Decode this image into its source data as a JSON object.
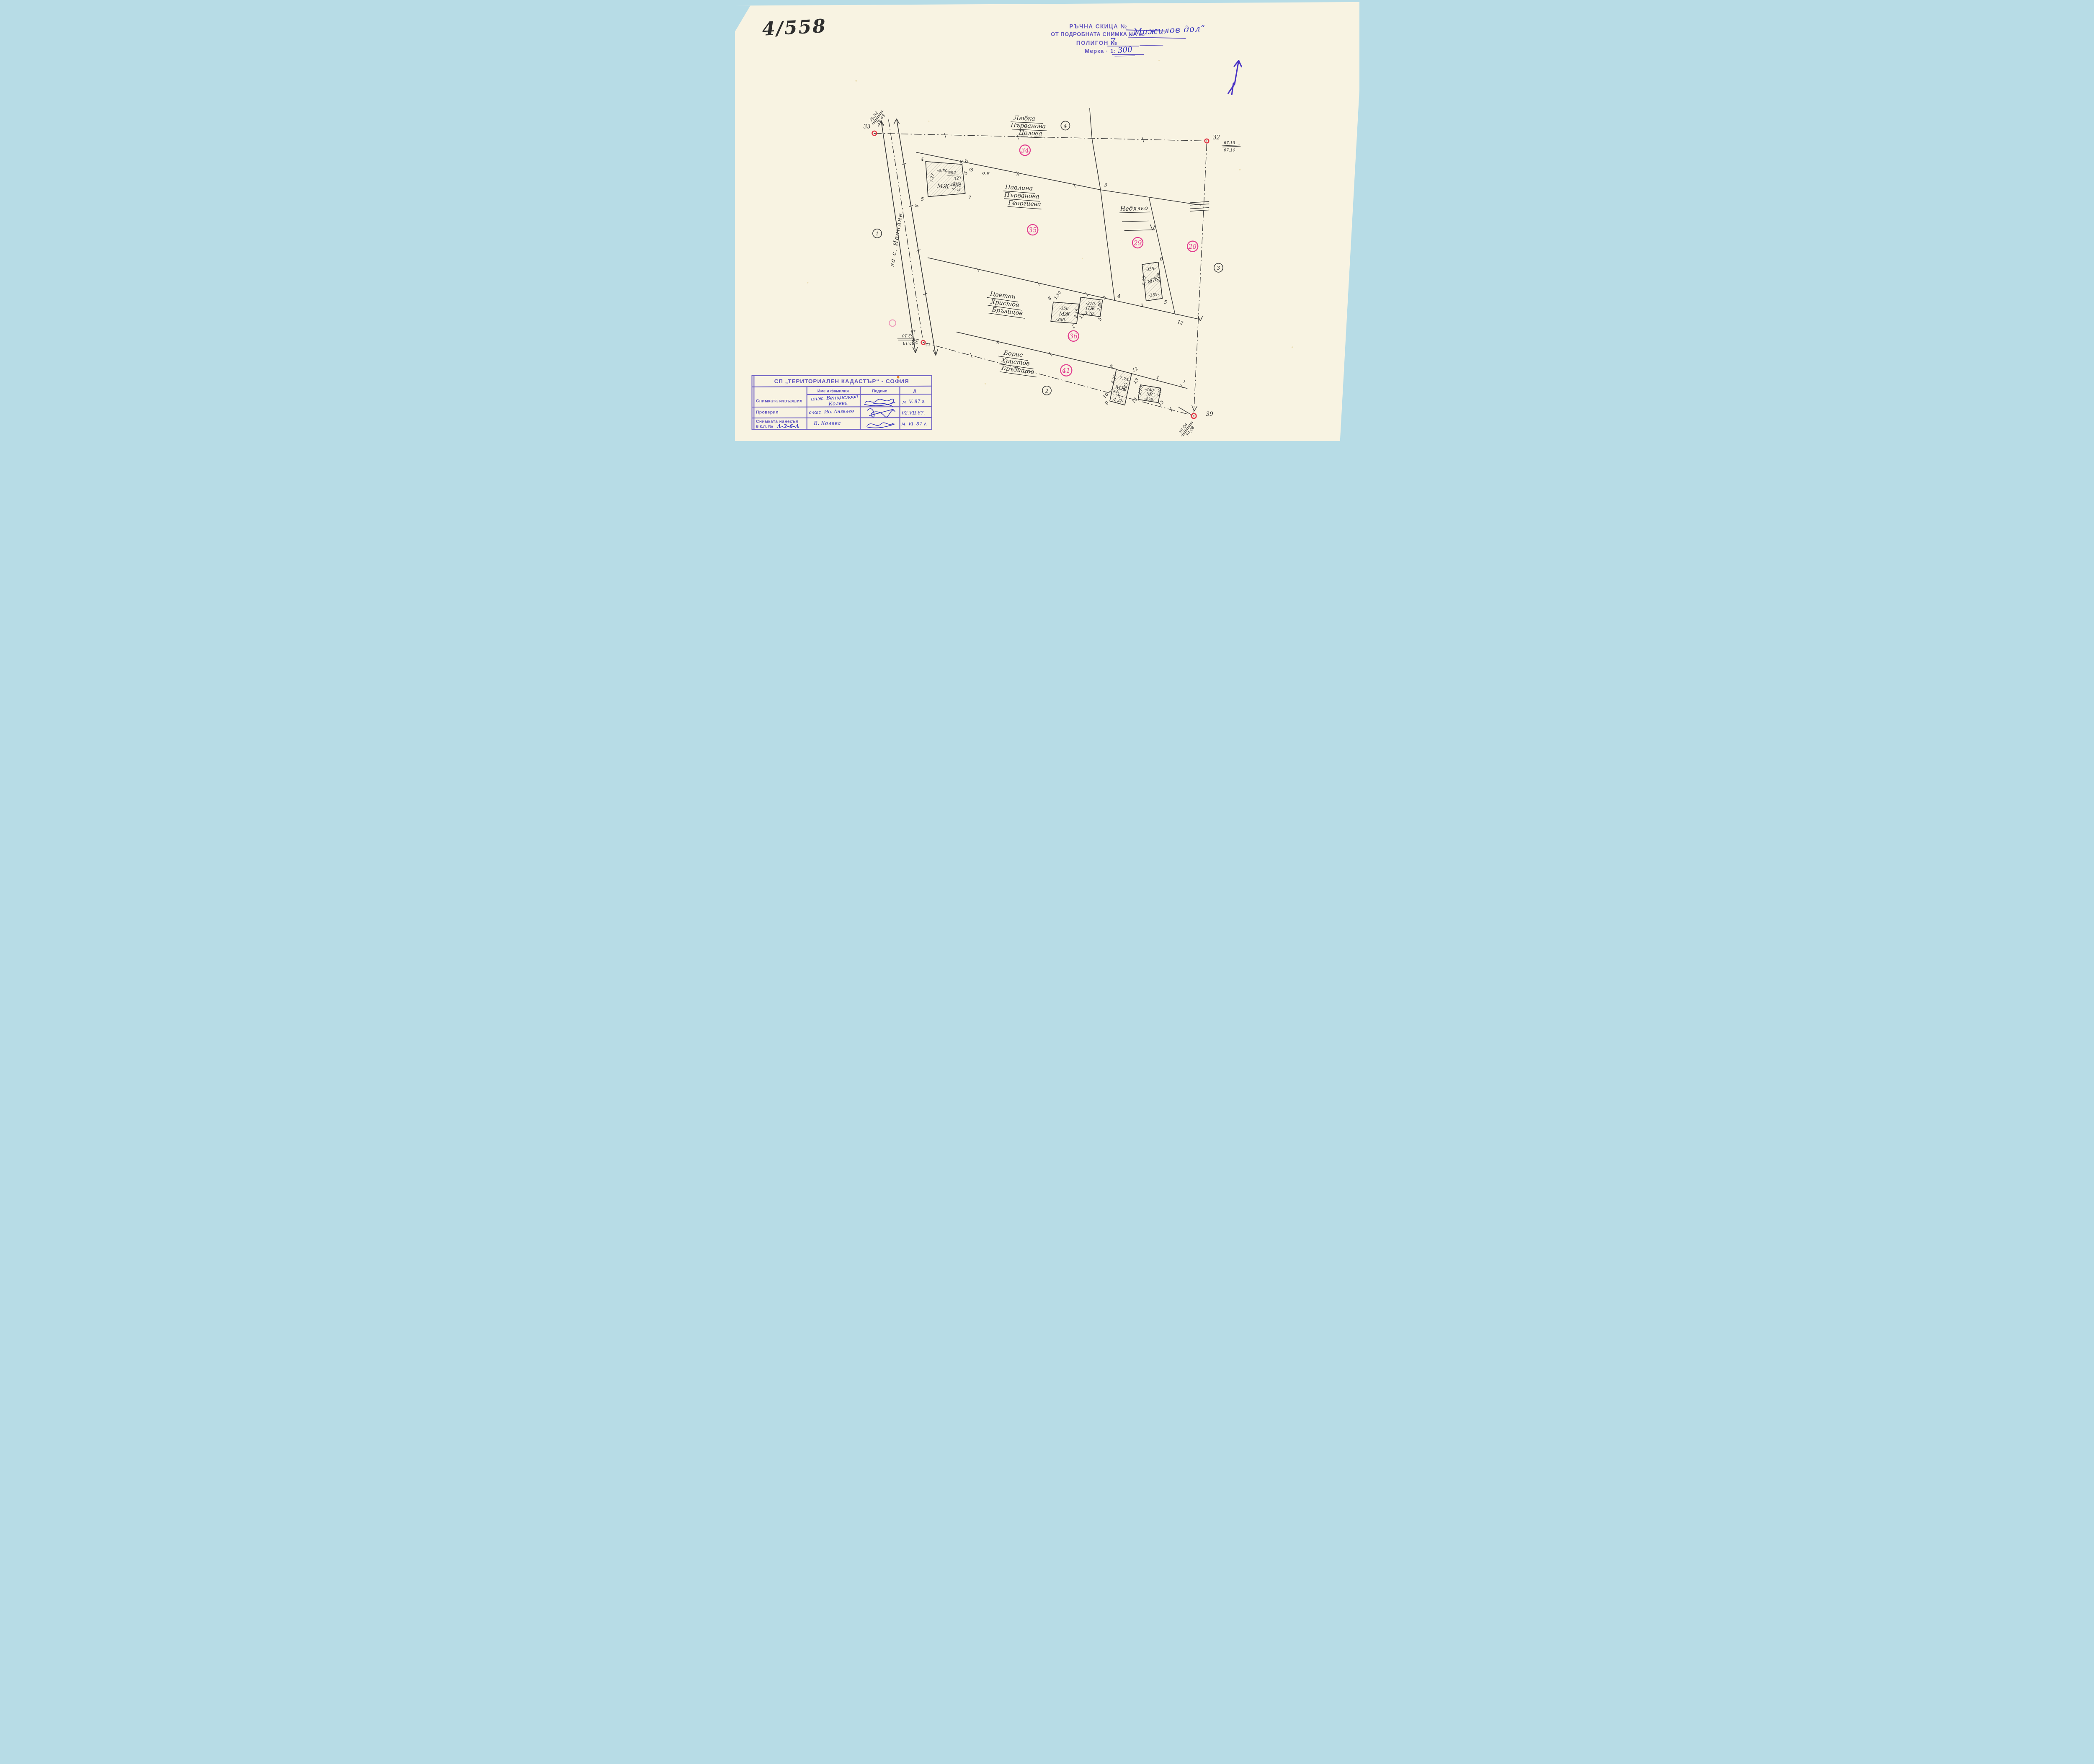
{
  "header": {
    "sheet_no": "4/558",
    "l1": "РЪЧНА СКИЦА №",
    "l2": "ОТ ПОДРОБНАТА СНИМКА НА м.",
    "place": "„Мажилов дол“",
    "l3": "ПОЛИГОН №",
    "poly_no": "7",
    "l4": "Мерка · 1:",
    "scale": "300"
  },
  "map": {
    "road_label": "за с. Иваняне",
    "circled": {
      "c1": "1",
      "c2": "2",
      "c3": "3",
      "c4": "4"
    },
    "parcels": {
      "p34": "34",
      "p35": "35",
      "p36": "36",
      "p41": "41",
      "p29": "29",
      "p28": "28"
    },
    "owners": {
      "lyubka": [
        "Любка",
        "Първанова",
        "Цолова"
      ],
      "pavlina": [
        "Павлина",
        "Първанова",
        "Георгиева"
      ],
      "nedyalko": [
        "Недялко"
      ],
      "tsvetan": [
        "Цветан",
        "Христов",
        "Бръзицов"
      ],
      "boris": [
        "Борис",
        "Христов",
        "Бръзищов"
      ]
    },
    "points": {
      "p33": {
        "no": "33",
        "a": "79,52",
        "b": "79,48",
        "extra": "2"
      },
      "p32": {
        "no": "32",
        "a": "67,13",
        "b": "67,10"
      },
      "p38": {
        "no": "38",
        "a": "52,13",
        "b": "52,10",
        "n14": "14",
        "n15": "15",
        "n8": "8"
      },
      "p39": {
        "no": "39",
        "a": "70,04",
        "b": "70,08"
      }
    },
    "junctions": {
      "j1": "1",
      "j3": "3",
      "j4": "4",
      "j12": "12"
    },
    "b1": {
      "type": "МЖ",
      "d_top": "-8,50-",
      "n692": "692",
      "n123": "123",
      "n415": "415",
      "d_left": "7,27",
      "d_r1": "6,91",
      "d_r2": "0,20",
      "c4": "4",
      "c6": "6",
      "c7": "7",
      "c5": "5",
      "p5": "5",
      "ok": "о.к"
    },
    "b2": {
      "type": "МЖ",
      "d_top": "-355-",
      "d_bot": "-355-",
      "d_left": "9,05",
      "d_right": "9,06",
      "cb": "б",
      "c5": "5",
      "c3": "3"
    },
    "b3": {
      "type": "МЖ",
      "d_top": "-350-",
      "d_bot": "-350-",
      "d_right": "2,16",
      "gap": "1,50",
      "c8": "8",
      "c2": "2",
      "c11": "11"
    },
    "b4": {
      "type": "ПЖ",
      "d_top": "-370-",
      "d_bot": "-3,70-",
      "d_right": "2,80",
      "c9": "9",
      "c5": "5"
    },
    "b5": {
      "type": "МЖ",
      "d_top": "-7,75-",
      "d_left": "5,28",
      "d_left2": "-3,44-",
      "d_right": "6,33",
      "d_bot": "4,32-",
      "c8": "8",
      "c12": "12",
      "c10": "10",
      "c9": "9",
      "t1": "1"
    },
    "b6": {
      "type": "МС",
      "d_top": "-440-",
      "d_bot": "-436-",
      "d_left": "2,70",
      "d_right": "2,10",
      "c13": "13",
      "c14": "14",
      "c15": "15"
    }
  },
  "stamp": {
    "org": "СП „ТЕРИТОРИАЛЕН КАДАСТЪР“ - СОФИЯ",
    "col_name": "Име и фамилия",
    "col_sign": "Подпис",
    "col_date": "Д",
    "r1_label": "Снимката извършил",
    "r1_name1": "инж. Венцислова",
    "r1_name2": "Колева",
    "r1_date": "м. V. 87 г.",
    "r2_label": "Проверил",
    "r2_name": "с-кас. Ив. Ангелев",
    "r2_date": "02.VII.87.",
    "r3_label1": "Снимката нанесъл",
    "r3_label2": "в к.л. №",
    "r3_klno": "А-2-6-А",
    "r3_name": "В. Колева",
    "r3_date": "м. VI. 87 г."
  }
}
